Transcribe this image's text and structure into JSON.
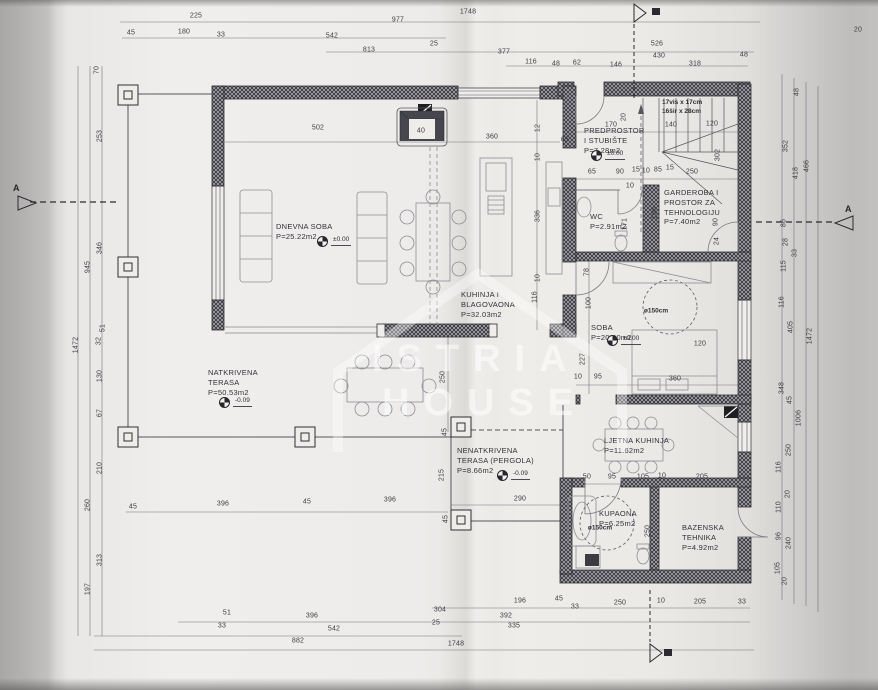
{
  "colors": {
    "paper": "#efedeb",
    "ink": "#3c3c44",
    "wall_ink": "#2e2e34",
    "watermark": "#ffffff"
  },
  "drawing": {
    "watermark": {
      "line1": "ISTRIA",
      "line2": "HOUSE"
    },
    "section_markers": {
      "left": "A",
      "right": "A"
    },
    "stair_note": {
      "lines": [
        "17vis x 17cm",
        "16šir x 28cm"
      ],
      "x": 662,
      "y": 99
    },
    "rooms": [
      {
        "lines": [
          "DNEVNA SOBA",
          "P=25.22m2"
        ],
        "x": 276,
        "y": 222
      },
      {
        "lines": [
          "KUHINJA I",
          "BLAGOVAONA",
          "P=32.03m2"
        ],
        "x": 461,
        "y": 290
      },
      {
        "lines": [
          "PREDPROSTOR",
          "I STUBIŠTE",
          "P=7.28m2"
        ],
        "x": 584,
        "y": 126
      },
      {
        "lines": [
          "WC",
          "P=2.91m2"
        ],
        "x": 590,
        "y": 212
      },
      {
        "lines": [
          "GARDEROBA I",
          "PROSTOR ZA",
          "TEHNOLOGIJU",
          "P=7.40m2"
        ],
        "x": 664,
        "y": 188
      },
      {
        "lines": [
          "SOBA",
          "P=20.40m2"
        ],
        "x": 591,
        "y": 323
      },
      {
        "lines": [
          "NATKRIVENA",
          "TERASA",
          "P=50.53m2"
        ],
        "x": 208,
        "y": 368
      },
      {
        "lines": [
          "NENATKRIVENA",
          "TERASA (PERGOLA)",
          "P=8.66m2"
        ],
        "x": 457,
        "y": 446
      },
      {
        "lines": [
          "LJETNA KUHINJA",
          "P=11.62m2"
        ],
        "x": 604,
        "y": 436
      },
      {
        "lines": [
          "KUPAONA",
          "P=6.25m2"
        ],
        "x": 599,
        "y": 509
      },
      {
        "lines": [
          "BAZENSKA",
          "TEHNIKA",
          "P=4.92m2"
        ],
        "x": 682,
        "y": 523
      }
    ],
    "circle_labels": [
      {
        "t": "ø150cm",
        "x": 656,
        "y": 311
      },
      {
        "t": "ø150cm",
        "x": 600,
        "y": 528
      }
    ],
    "level_markers": [
      {
        "t": "±0.00",
        "x": 322,
        "y": 241
      },
      {
        "t": "-0.09",
        "x": 224,
        "y": 402
      },
      {
        "t": "±0.00",
        "x": 596,
        "y": 155
      },
      {
        "t": "±0.00",
        "x": 612,
        "y": 340
      },
      {
        "t": "-0.09",
        "x": 502,
        "y": 475
      }
    ],
    "dims": {
      "top": [
        {
          "t": "225",
          "x": 196,
          "y": 16
        },
        {
          "t": "977",
          "x": 398,
          "y": 20
        },
        {
          "t": "1748",
          "x": 468,
          "y": 12
        },
        {
          "t": "45",
          "x": 131,
          "y": 33
        },
        {
          "t": "180",
          "x": 184,
          "y": 32
        },
        {
          "t": "33",
          "x": 221,
          "y": 35
        },
        {
          "t": "542",
          "x": 332,
          "y": 36
        },
        {
          "t": "25",
          "x": 434,
          "y": 44
        },
        {
          "t": "813",
          "x": 369,
          "y": 50
        },
        {
          "t": "377",
          "x": 504,
          "y": 52
        },
        {
          "t": "526",
          "x": 657,
          "y": 44
        },
        {
          "t": "430",
          "x": 659,
          "y": 56
        },
        {
          "t": "48",
          "x": 744,
          "y": 55
        },
        {
          "t": "116",
          "x": 531,
          "y": 62
        },
        {
          "t": "48",
          "x": 556,
          "y": 64
        },
        {
          "t": "62",
          "x": 577,
          "y": 63
        },
        {
          "t": "146",
          "x": 616,
          "y": 65
        },
        {
          "t": "318",
          "x": 695,
          "y": 64
        },
        {
          "t": "20",
          "x": 858,
          "y": 30
        }
      ],
      "left": [
        {
          "t": "70",
          "x": 97,
          "y": 70,
          "r": -90
        },
        {
          "t": "253",
          "x": 100,
          "y": 136,
          "r": -90
        },
        {
          "t": "346",
          "x": 100,
          "y": 248,
          "r": -90
        },
        {
          "t": "945",
          "x": 88,
          "y": 267,
          "r": -90
        },
        {
          "t": "51",
          "x": 103,
          "y": 328,
          "r": -90
        },
        {
          "t": "32",
          "x": 99,
          "y": 341,
          "r": -90
        },
        {
          "t": "1472",
          "x": 76,
          "y": 345,
          "r": -90
        },
        {
          "t": "130",
          "x": 100,
          "y": 376,
          "r": -90
        },
        {
          "t": "67",
          "x": 100,
          "y": 413,
          "r": -90
        },
        {
          "t": "210",
          "x": 100,
          "y": 468,
          "r": -90
        },
        {
          "t": "260",
          "x": 88,
          "y": 505,
          "r": -90
        },
        {
          "t": "313",
          "x": 100,
          "y": 560,
          "r": -90
        },
        {
          "t": "197",
          "x": 88,
          "y": 589,
          "r": -90
        }
      ],
      "right": [
        {
          "t": "48",
          "x": 797,
          "y": 92,
          "r": -90
        },
        {
          "t": "352",
          "x": 786,
          "y": 146,
          "r": -90
        },
        {
          "t": "418",
          "x": 796,
          "y": 173,
          "r": -90
        },
        {
          "t": "466",
          "x": 807,
          "y": 166,
          "r": -90
        },
        {
          "t": "86",
          "x": 784,
          "y": 223,
          "r": -90
        },
        {
          "t": "28",
          "x": 786,
          "y": 242,
          "r": -90
        },
        {
          "t": "33",
          "x": 795,
          "y": 253,
          "r": -90
        },
        {
          "t": "115",
          "x": 784,
          "y": 266,
          "r": -90
        },
        {
          "t": "116",
          "x": 782,
          "y": 302,
          "r": -90
        },
        {
          "t": "405",
          "x": 791,
          "y": 327,
          "r": -90
        },
        {
          "t": "1472",
          "x": 810,
          "y": 336,
          "r": -90
        },
        {
          "t": "348",
          "x": 782,
          "y": 388,
          "r": -90
        },
        {
          "t": "45",
          "x": 790,
          "y": 400,
          "r": -90
        },
        {
          "t": "1006",
          "x": 799,
          "y": 418,
          "r": -90
        },
        {
          "t": "250",
          "x": 789,
          "y": 450,
          "r": -90
        },
        {
          "t": "116",
          "x": 779,
          "y": 467,
          "r": -90
        },
        {
          "t": "20",
          "x": 788,
          "y": 494,
          "r": -90
        },
        {
          "t": "110",
          "x": 779,
          "y": 507,
          "r": -90
        },
        {
          "t": "96",
          "x": 779,
          "y": 536,
          "r": -90
        },
        {
          "t": "240",
          "x": 789,
          "y": 543,
          "r": -90
        },
        {
          "t": "105",
          "x": 778,
          "y": 568,
          "r": -90
        },
        {
          "t": "20",
          "x": 785,
          "y": 581,
          "r": -90
        }
      ],
      "bottom": [
        {
          "t": "45",
          "x": 133,
          "y": 507
        },
        {
          "t": "396",
          "x": 223,
          "y": 504
        },
        {
          "t": "45",
          "x": 307,
          "y": 502
        },
        {
          "t": "396",
          "x": 390,
          "y": 500
        },
        {
          "t": "196",
          "x": 520,
          "y": 601
        },
        {
          "t": "45",
          "x": 559,
          "y": 599
        },
        {
          "t": "33",
          "x": 575,
          "y": 607
        },
        {
          "t": "250",
          "x": 620,
          "y": 603
        },
        {
          "t": "10",
          "x": 661,
          "y": 601
        },
        {
          "t": "205",
          "x": 700,
          "y": 602
        },
        {
          "t": "33",
          "x": 742,
          "y": 602
        },
        {
          "t": "304",
          "x": 440,
          "y": 610
        },
        {
          "t": "51",
          "x": 227,
          "y": 613
        },
        {
          "t": "396",
          "x": 312,
          "y": 616
        },
        {
          "t": "25",
          "x": 436,
          "y": 623
        },
        {
          "t": "392",
          "x": 506,
          "y": 616
        },
        {
          "t": "33",
          "x": 222,
          "y": 626
        },
        {
          "t": "542",
          "x": 334,
          "y": 629
        },
        {
          "t": "335",
          "x": 514,
          "y": 626
        },
        {
          "t": "882",
          "x": 298,
          "y": 641
        },
        {
          "t": "1748",
          "x": 456,
          "y": 644
        }
      ],
      "inner": [
        {
          "t": "502",
          "x": 318,
          "y": 128
        },
        {
          "t": "40",
          "x": 421,
          "y": 131
        },
        {
          "t": "360",
          "x": 492,
          "y": 137
        },
        {
          "t": "65",
          "x": 565,
          "y": 140
        },
        {
          "t": "12",
          "x": 538,
          "y": 128,
          "r": -90
        },
        {
          "t": "10",
          "x": 538,
          "y": 157,
          "r": -90
        },
        {
          "t": "336",
          "x": 538,
          "y": 216,
          "r": -90
        },
        {
          "t": "10",
          "x": 538,
          "y": 278,
          "r": -90
        },
        {
          "t": "170",
          "x": 611,
          "y": 125
        },
        {
          "t": "20",
          "x": 624,
          "y": 117,
          "r": -90
        },
        {
          "t": "140",
          "x": 671,
          "y": 125
        },
        {
          "t": "120",
          "x": 712,
          "y": 124
        },
        {
          "t": "302",
          "x": 718,
          "y": 155,
          "r": -90
        },
        {
          "t": "65",
          "x": 592,
          "y": 172
        },
        {
          "t": "90",
          "x": 620,
          "y": 172
        },
        {
          "t": "15",
          "x": 636,
          "y": 170
        },
        {
          "t": "10",
          "x": 646,
          "y": 171
        },
        {
          "t": "85",
          "x": 658,
          "y": 170
        },
        {
          "t": "15",
          "x": 670,
          "y": 168
        },
        {
          "t": "250",
          "x": 692,
          "y": 172
        },
        {
          "t": "10",
          "x": 630,
          "y": 186
        },
        {
          "t": "171",
          "x": 625,
          "y": 224,
          "r": -90
        },
        {
          "t": "196",
          "x": 655,
          "y": 213,
          "r": -90
        },
        {
          "t": "90",
          "x": 716,
          "y": 222,
          "r": -90
        },
        {
          "t": "24",
          "x": 717,
          "y": 241,
          "r": -90
        },
        {
          "t": "116",
          "x": 535,
          "y": 297,
          "r": -90
        },
        {
          "t": "78",
          "x": 587,
          "y": 272,
          "r": -90
        },
        {
          "t": "100",
          "x": 589,
          "y": 303,
          "r": -90
        },
        {
          "t": "227",
          "x": 583,
          "y": 359,
          "r": -90
        },
        {
          "t": "10",
          "x": 578,
          "y": 377
        },
        {
          "t": "95",
          "x": 598,
          "y": 377
        },
        {
          "t": "360",
          "x": 675,
          "y": 379
        },
        {
          "t": "120",
          "x": 700,
          "y": 344
        },
        {
          "t": "250",
          "x": 443,
          "y": 377,
          "r": -90
        },
        {
          "t": "45",
          "x": 445,
          "y": 432,
          "r": -90
        },
        {
          "t": "215",
          "x": 442,
          "y": 475,
          "r": -90
        },
        {
          "t": "45",
          "x": 446,
          "y": 519,
          "r": -90
        },
        {
          "t": "290",
          "x": 520,
          "y": 499
        },
        {
          "t": "50",
          "x": 587,
          "y": 477
        },
        {
          "t": "95",
          "x": 612,
          "y": 477
        },
        {
          "t": "105",
          "x": 643,
          "y": 477
        },
        {
          "t": "10",
          "x": 662,
          "y": 476
        },
        {
          "t": "205",
          "x": 702,
          "y": 477
        },
        {
          "t": "250",
          "x": 648,
          "y": 531,
          "r": -90
        }
      ]
    }
  }
}
